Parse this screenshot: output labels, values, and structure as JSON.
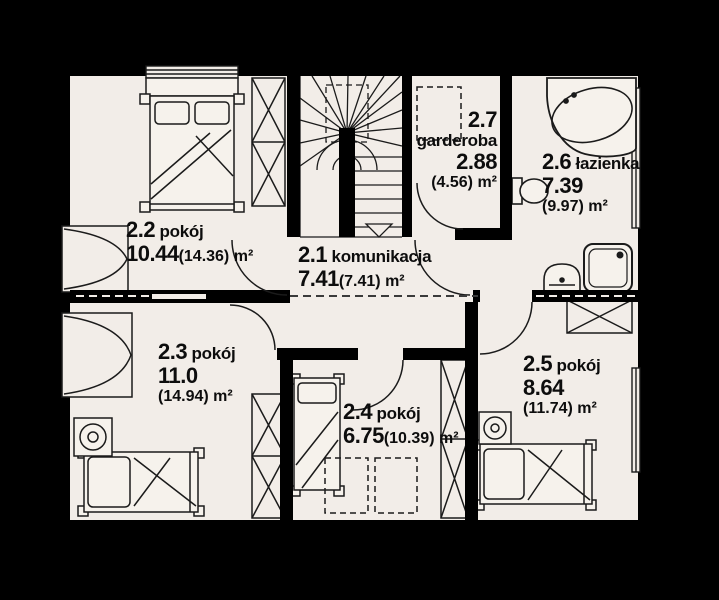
{
  "colors": {
    "background": "#000000",
    "floor": "#f2ede8",
    "wall": "#000000",
    "line": "#1b1b1b"
  },
  "rooms": {
    "r21": {
      "number": "2.1",
      "name": "komunikacja",
      "area": "7.41",
      "area_total": "(7.41)",
      "unit": "m²"
    },
    "r22": {
      "number": "2.2",
      "name": "pokój",
      "area": "10.44",
      "area_total": "(14.36)",
      "unit": "m²"
    },
    "r23": {
      "number": "2.3",
      "name": "pokój",
      "area": "11.0",
      "area_total": "(14.94)",
      "unit": "m²"
    },
    "r24": {
      "number": "2.4",
      "name": "pokój",
      "area": "6.75",
      "area_total": "(10.39)",
      "unit": "m²"
    },
    "r25": {
      "number": "2.5",
      "name": "pokój",
      "area": "8.64",
      "area_total": "(11.74)",
      "unit": "m²"
    },
    "r26": {
      "number": "2.6",
      "name": "łazienka",
      "area": "7.39",
      "area_total": "(9.97)",
      "unit": "m²"
    },
    "r27": {
      "number": "2.7",
      "name": "garderoba",
      "area": "2.88",
      "area_total": "(4.56)",
      "unit": "m²"
    }
  },
  "furniture": {
    "double_bed": "double-bed",
    "single_beds": "single-bed",
    "wardrobes": "wardrobe",
    "bathtub": "corner-bathtub",
    "toilet": "toilet",
    "sink": "sink",
    "shower": "shower-cabin",
    "stairs": "winder-staircase"
  }
}
